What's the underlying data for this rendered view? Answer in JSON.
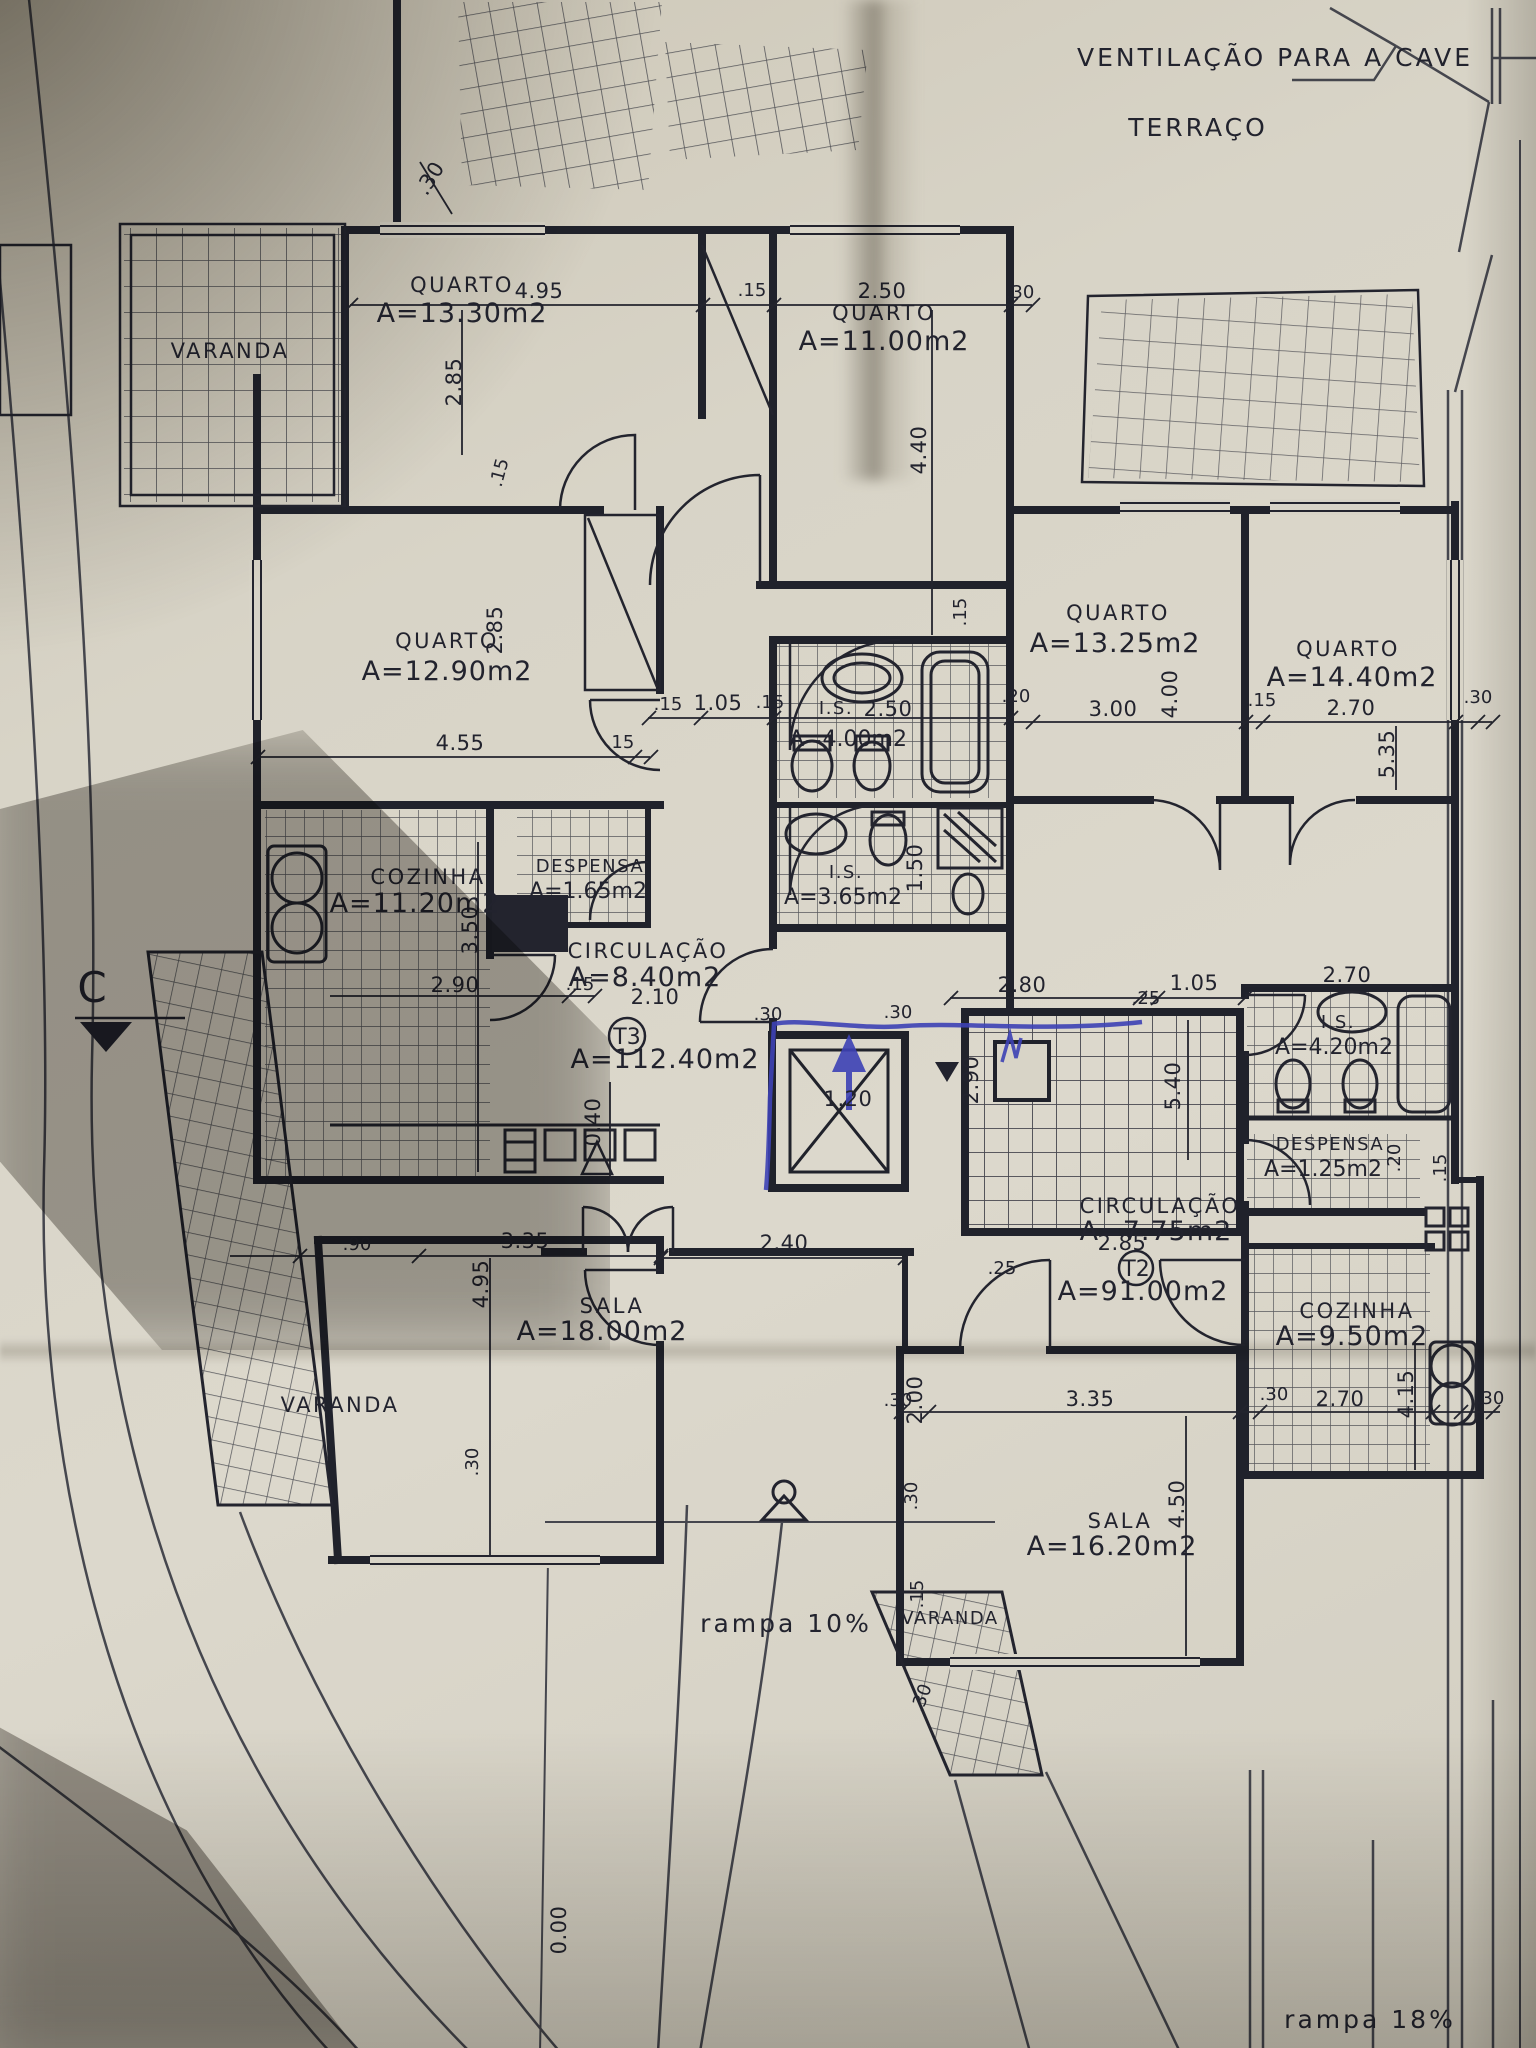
{
  "annotations": {
    "ventilacao": "VENTILAÇÃO PARA A CAVE",
    "terraco": "TERRAÇO",
    "rampa_10": "rampa  10%",
    "rampa_18": "rampa  18%",
    "section_c": "C",
    "level_zero": "0.00",
    "level_040": "0.40"
  },
  "apartments": {
    "t3": {
      "tag": "T3",
      "area": "A=112.40m2"
    },
    "t2": {
      "tag": "T2",
      "area": "A=91.00m2"
    }
  },
  "rooms": {
    "varanda_tl": {
      "name": "VARANDA"
    },
    "quarto_1330": {
      "name": "QUARTO",
      "area": "A=13.30m2"
    },
    "quarto_1100": {
      "name": "QUARTO",
      "area": "A=11.00m2"
    },
    "quarto_1290": {
      "name": "QUARTO",
      "area": "A=12.90m2"
    },
    "quarto_1325": {
      "name": "QUARTO",
      "area": "A=13.25m2"
    },
    "quarto_1440": {
      "name": "QUARTO",
      "area": "A=14.40m2"
    },
    "cozinha_t3": {
      "name": "COZINHA",
      "area": "A=11.20m2"
    },
    "despensa_t3": {
      "name": "DESPENSA",
      "area": "A=1.65m2"
    },
    "is_400": {
      "name": "I.S.",
      "area": "A=4.00m2"
    },
    "is_365": {
      "name": "I.S.",
      "area": "A=3.65m2"
    },
    "circulacao_t3": {
      "name": "CIRCULAÇÃO",
      "area": "A=8.40m2"
    },
    "is_420": {
      "name": "I.S.",
      "area": "A=4.20m2"
    },
    "despensa_t2": {
      "name": "DESPENSA",
      "area": "A=1.25m2"
    },
    "circulacao_t2": {
      "name": "CIRCULAÇÃO",
      "area": "A=7.75m2"
    },
    "cozinha_t2": {
      "name": "COZINHA",
      "area": "A=9.50m2"
    },
    "sala_t3": {
      "name": "SALA",
      "area": "A=18.00m2"
    },
    "sala_t2": {
      "name": "SALA",
      "area": "A=16.20m2"
    },
    "varanda_left": {
      "name": "VARANDA"
    },
    "varanda_bottom": {
      "name": "VARANDA"
    }
  },
  "dims": {
    "top_30": ".30",
    "top_495": "4.95",
    "top_15": ".15",
    "top_250": "2.50",
    "top_30b": ".30",
    "v_285": "2.85",
    "v_440": "4.40",
    "q12_15": ".15",
    "q12_455": "4.55",
    "q12_15b": ".15",
    "q12_285": "2.85",
    "mid_15a": ".15",
    "mid_105": "1.05",
    "mid_15b": ".15",
    "is400_250": "2.50",
    "v_15_bath": ".15",
    "v_150": "1.50",
    "koz_350": "3.50",
    "koz_290": "2.90",
    "koz_15": ".15",
    "circ_210": "2.10",
    "elev_120": "1.20",
    "elev_30a": ".30",
    "elev_30b": ".30",
    "stair_280": "2.80",
    "stair_25": ".25",
    "stair_105": "1.05",
    "stair_540": "5.40",
    "stair_290": "2.90",
    "r_20": ".20",
    "r_300": "3.00",
    "r_400": "4.00",
    "r_15": ".15",
    "r_270": "2.70",
    "r_535": "5.35",
    "r_30": ".30",
    "is420_270": "2.70",
    "desp2_20": ".20",
    "desp2_15": ".15",
    "c775_285": "2.85",
    "t2_25": ".25",
    "koz2_270": "2.70",
    "koz2_415": "4.15",
    "koz2_30": ".30",
    "sala3_90": ".90",
    "sala3_335": "3.35",
    "sala3_495": "4.95",
    "sala3_30": ".30",
    "ent_240": "2.40",
    "sala2_30": ".30",
    "sala2_200": "2.00",
    "sala2_335": "3.35",
    "sala2_450": "4.50",
    "sala2_30b": ".30",
    "var2_30t": ".30",
    "var2_15": ".15",
    "var2_30b": ".30"
  }
}
